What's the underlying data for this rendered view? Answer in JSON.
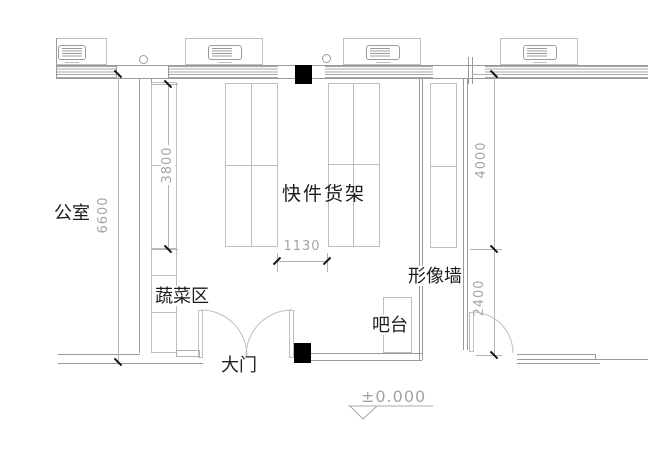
{
  "title": "store floor plan",
  "labels": {
    "office": "公室",
    "express_shelf": "快件货架",
    "vegetable_area": "蔬菜区",
    "main_door": "大门",
    "bar_counter": "吧台",
    "image_wall": "形像墙"
  },
  "dimensions": {
    "left_total": "6600",
    "left_shelf": "3800",
    "center_aisle": "1130",
    "right_upper": "4000",
    "right_lower": "2400"
  },
  "elevation": {
    "value": "±0.000"
  }
}
